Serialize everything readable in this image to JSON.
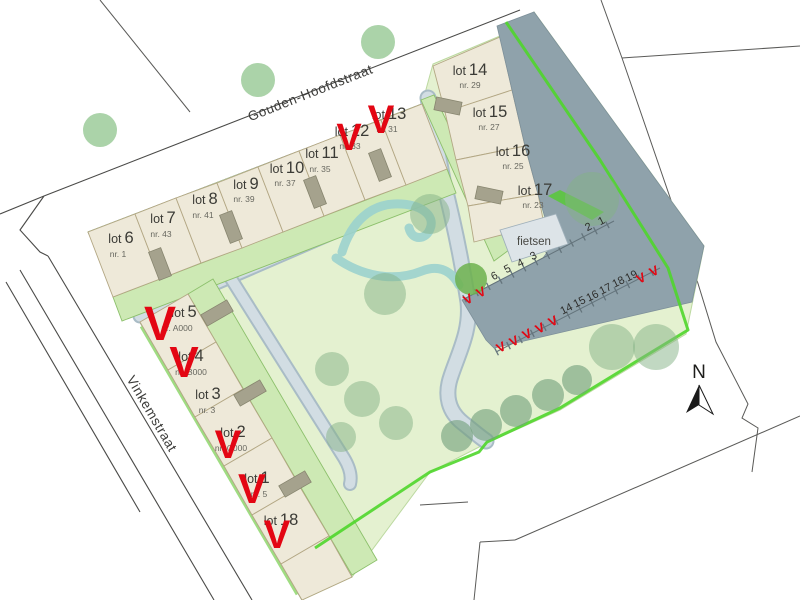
{
  "legend": {
    "sold_mark": "V"
  },
  "north": {
    "label": "N"
  },
  "streets": {
    "top": "Gouden-Hoofdstraat",
    "left": "Vinkemstraat"
  },
  "facilities": {
    "bike_storage": "fietsen"
  },
  "lots": [
    {
      "prefix": "lot",
      "num": "6",
      "sub": "nr. 1",
      "sold": false
    },
    {
      "prefix": "lot",
      "num": "7",
      "sub": "nr. 43",
      "sold": false
    },
    {
      "prefix": "lot",
      "num": "8",
      "sub": "nr. 41",
      "sold": false
    },
    {
      "prefix": "lot",
      "num": "9",
      "sub": "nr. 39",
      "sold": false
    },
    {
      "prefix": "lot",
      "num": "10",
      "sub": "nr. 37",
      "sold": false
    },
    {
      "prefix": "lot",
      "num": "11",
      "sub": "nr. 35",
      "sold": false
    },
    {
      "prefix": "lot",
      "num": "12",
      "sub": "nr. 33",
      "sold": true
    },
    {
      "prefix": "lot",
      "num": "13",
      "sub": "nr. 31",
      "sold": true
    },
    {
      "prefix": "lot",
      "num": "14",
      "sub": "nr. 29",
      "sold": false
    },
    {
      "prefix": "lot",
      "num": "15",
      "sub": "nr. 27",
      "sold": false
    },
    {
      "prefix": "lot",
      "num": "16",
      "sub": "nr. 25",
      "sold": false
    },
    {
      "prefix": "lot",
      "num": "17",
      "sub": "nr. 23",
      "sold": false
    },
    {
      "prefix": "lot",
      "num": "5",
      "sub": "nr. A000",
      "sold": true
    },
    {
      "prefix": "lot",
      "num": "4",
      "sub": "nr. B000",
      "sold": true
    },
    {
      "prefix": "lot",
      "num": "3",
      "sub": "nr. 3",
      "sold": false
    },
    {
      "prefix": "lot",
      "num": "2",
      "sub": "nr. C000",
      "sold": true
    },
    {
      "prefix": "lot",
      "num": "1",
      "sub": "nr. 5",
      "sold": true
    },
    {
      "prefix": "lot",
      "num": "18",
      "sub": "",
      "sold": true
    }
  ],
  "parking": {
    "upper_numbers": [
      "1",
      "2",
      "3",
      "4",
      "5",
      "6"
    ],
    "lower_numbers": [
      "14",
      "15",
      "16",
      "17",
      "18",
      "19"
    ],
    "upper_sold_count": 2,
    "lower_sold_left_count": 5,
    "lower_sold_right_count": 2
  },
  "colors": {
    "sold_red": "#e30613",
    "boundary_green": "#4fd62b",
    "lot_beige": "#eee9d9",
    "garden_green": "#cde9b4",
    "park_green": "#e4f1d0",
    "road_gray": "#8fa2ab",
    "path_gray": "#d2dde3",
    "water_teal": "#9cd2ce"
  }
}
